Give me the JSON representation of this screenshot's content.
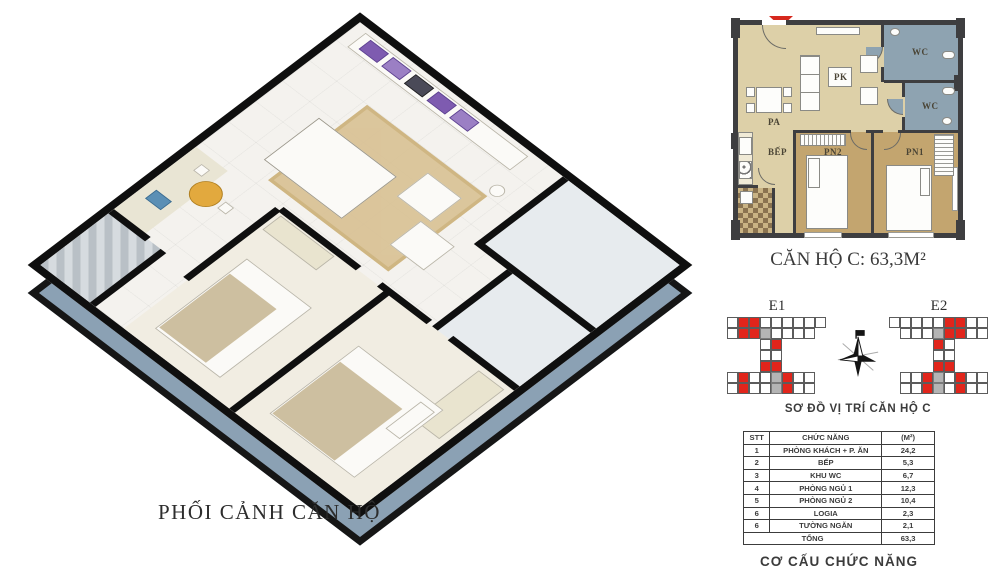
{
  "render3d": {
    "caption": "PHỐI CẢNH CĂN HỘ"
  },
  "plan": {
    "title": "CĂN HỘ C: 63,3M²",
    "labels": {
      "living": "PK",
      "dining": "PA",
      "kitchen": "BẾP",
      "bedroom1": "PN1",
      "bedroom2": "PN2",
      "wc1": "WC",
      "wc2": "WC"
    }
  },
  "position": {
    "caption": "SƠ ĐỒ VỊ TRÍ CĂN HỘ C",
    "blocks": [
      {
        "label": "E1",
        "grid": [
          "WRRWWWWWW",
          "WRRGWWWW.",
          "...WR....",
          "...WW....",
          "...RR....",
          "WRWWGRWW.",
          "WRWWGRWW."
        ]
      },
      {
        "label": "E2",
        "grid": [
          "WWWWWRRWW",
          ".WWWGRRWW",
          "....RW...",
          "....WW...",
          "....RR...",
          ".WWRGWRWW",
          ".WWRGWRWW"
        ]
      }
    ]
  },
  "area_table": {
    "headers": [
      "STT",
      "CHỨC NĂNG",
      "(M²)"
    ],
    "rows": [
      [
        "1",
        "PHÒNG KHÁCH + P. ĂN",
        "24,2"
      ],
      [
        "2",
        "BẾP",
        "5,3"
      ],
      [
        "3",
        "KHU WC",
        "6,7"
      ],
      [
        "4",
        "PHÒNG NGỦ 1",
        "12,3"
      ],
      [
        "5",
        "PHÒNG NGỦ 2",
        "10,4"
      ],
      [
        "6",
        "LOGIA",
        "2,3"
      ],
      [
        "6",
        "TƯỜNG NGĂN",
        "2,1"
      ]
    ],
    "total": {
      "label": "TỔNG",
      "value": "63,3"
    },
    "caption": "CƠ CẤU CHỨC NĂNG"
  },
  "colors": {
    "accent_red": "#e1251b",
    "plan_beige": "#ddd0a8",
    "bedroom_tan": "#c3a56f",
    "wc_blue": "#8ea3b1",
    "wall_dark": "#3e3e40",
    "slab_blue": "#8ba1b4"
  }
}
